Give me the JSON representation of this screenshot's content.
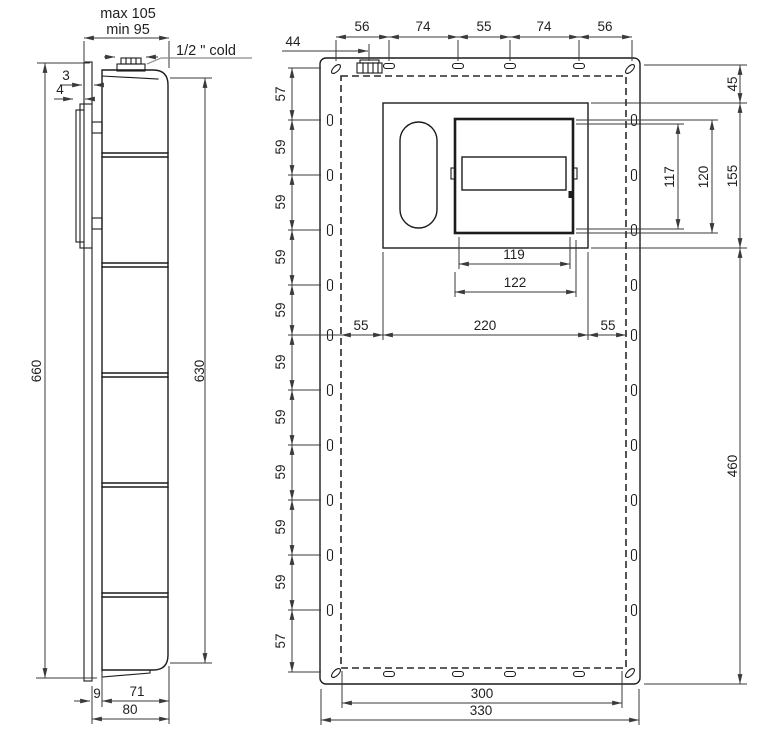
{
  "side_view": {
    "depth_max": "max 105",
    "depth_min": "min 95",
    "cold_connection": "1/2 \" cold",
    "front_plate_thickness": "3",
    "frame_gap": "4",
    "overall_height": "660",
    "front_height": "630",
    "wall_offset": "9",
    "body_depth": "71",
    "total_depth": "80"
  },
  "front_view": {
    "inlet_offset": "44",
    "top_spacing": [
      "56",
      "74",
      "55",
      "74",
      "56"
    ],
    "side_spacing": [
      "57",
      "59",
      "59",
      "59",
      "59",
      "59",
      "59",
      "59",
      "59",
      "59",
      "57"
    ],
    "top_margin": "45",
    "window_inner_height": "117",
    "window_outer_height": "120",
    "recess_panel_height": "155",
    "lower_section_height": "460",
    "window_inner_width": "119",
    "window_outer_width": "122",
    "left_margin": "55",
    "recess_panel_width": "220",
    "right_margin": "55",
    "slot_span_width": "300",
    "overall_width": "330"
  },
  "colors": {
    "line": "#1c1c1c",
    "dimension": "#3a3a3a",
    "accent_blue": "#2136d4"
  }
}
